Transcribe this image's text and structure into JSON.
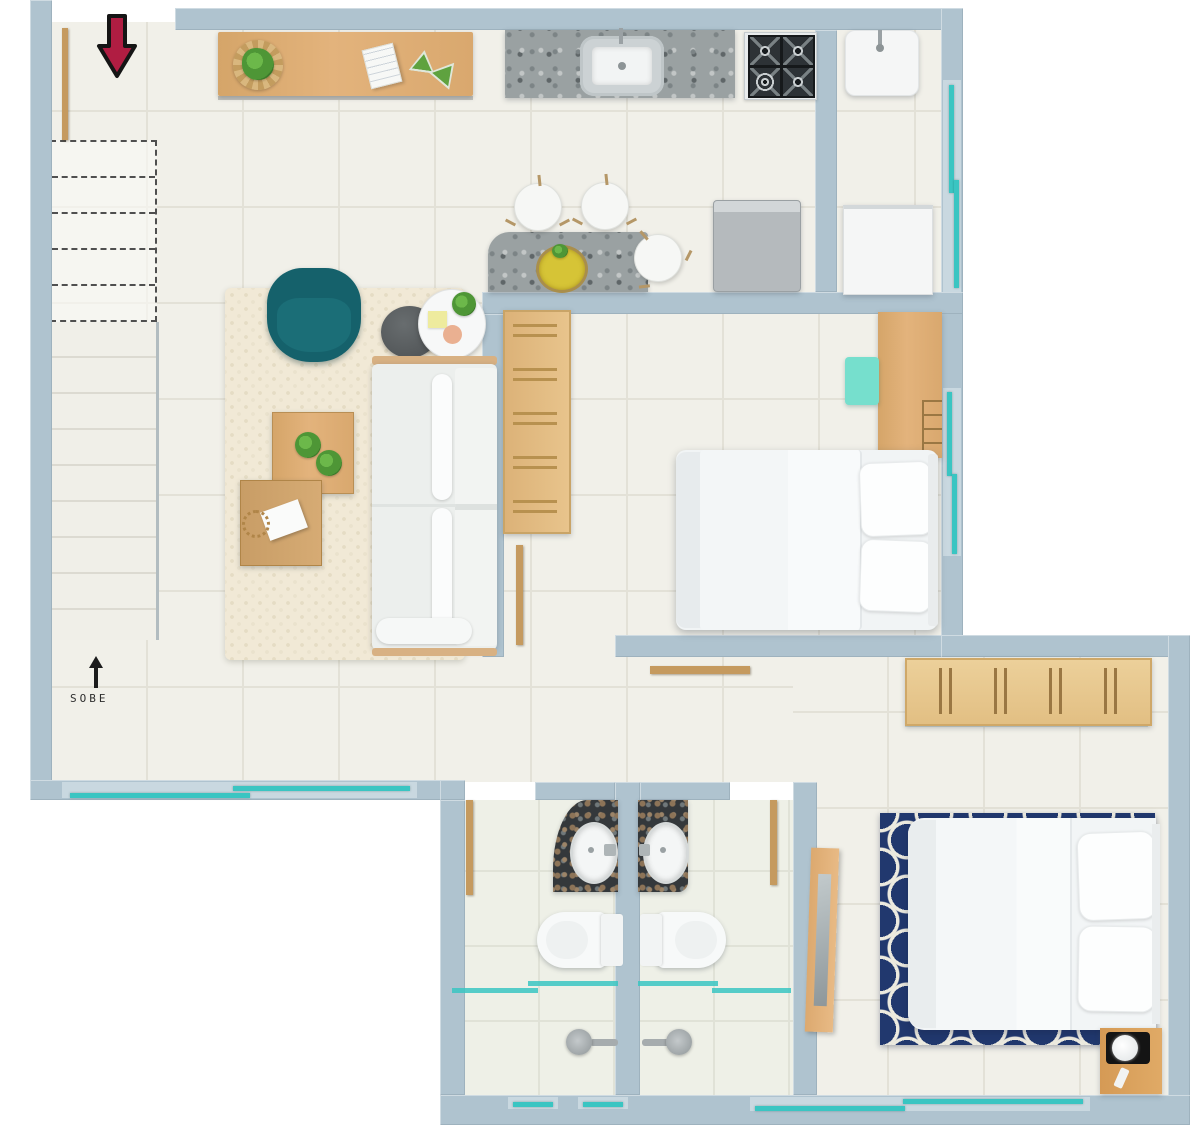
{
  "meta": {
    "type": "apartment-floor-plan",
    "view": "top-down 3d render",
    "width_px": 1200,
    "height_px": 1125
  },
  "labels": {
    "stairs_label": "SOBE"
  },
  "annotations": {
    "entry_arrow_direction": "down (entry at top-left)",
    "stairs_direction_arrow": "up",
    "dashed_outline_meaning": "stair flight above cut plane"
  },
  "colors": {
    "wall": "#afc3cf",
    "wall_light": "#cfdde4",
    "floor": "#f1f0e9",
    "tile_line": "#e3e1d7",
    "bath_floor": "#eef0e7",
    "window_teal": "#3ac5c2",
    "wood": "#d9ab74",
    "wood_dark": "#c59a5f",
    "teal_armchair": "#15616b",
    "mint_chair": "#76dfcd",
    "navy": "#21386e",
    "granite_gray": "#9aa1a2",
    "granite_dark": "#34383b",
    "red_arrow": "#b01d42",
    "ink": "#2e2e2e"
  },
  "rooms": [
    {
      "name": "kitchen",
      "furniture": [
        "wood sideboard with basket plant, book, two plants",
        "granite counter with sink and faucet",
        "4-burner cooktop",
        "refrigerator"
      ]
    },
    {
      "name": "laundry",
      "furniture": [
        "wash tank with faucet",
        "washing machine"
      ],
      "windows": [
        "right wall sliding window"
      ]
    },
    {
      "name": "dining",
      "furniture": [
        "granite table with fruit bowl",
        "3 round white chairs"
      ]
    },
    {
      "name": "living-room",
      "furniture": [
        "cream rug",
        "teal armchair",
        "dark round side table",
        "white round side table with plant and notes",
        "white sofa with wood trim",
        "2 wood coffee tables with plants and paper"
      ],
      "windows": [
        "bottom wall sliding window"
      ]
    },
    {
      "name": "stairs",
      "label": "SOBE",
      "detail": "lower flight solid treads, upper flight dashed"
    },
    {
      "name": "bedroom-1",
      "furniture": [
        "double bed with 2 pillows",
        "wood desk with cube shelves",
        "mint desk chair",
        "slatted wood rack",
        "open door leaf"
      ],
      "windows": [
        "right wall sliding window"
      ]
    },
    {
      "name": "hallway",
      "furniture": [
        "open wood door leaf"
      ]
    },
    {
      "name": "bathroom-1",
      "furniture": [
        "dark granite vanity with oval sink",
        "toilet",
        "shower head",
        "teal glass shower partition"
      ],
      "windows": [
        "small bottom window"
      ]
    },
    {
      "name": "bathroom-2",
      "furniture": [
        "dark granite vanity with oval sink",
        "toilet",
        "shower head",
        "teal glass shower partition"
      ],
      "windows": [
        "small bottom window"
      ]
    },
    {
      "name": "bedroom-2",
      "furniture": [
        "double bed with 2 pillows",
        "navy trellis rug",
        "slatted wood wardrobe",
        "wood nightstand with black tray and white lamp",
        "leaning mirror"
      ],
      "windows": [
        "bottom wall sliding window"
      ]
    }
  ]
}
